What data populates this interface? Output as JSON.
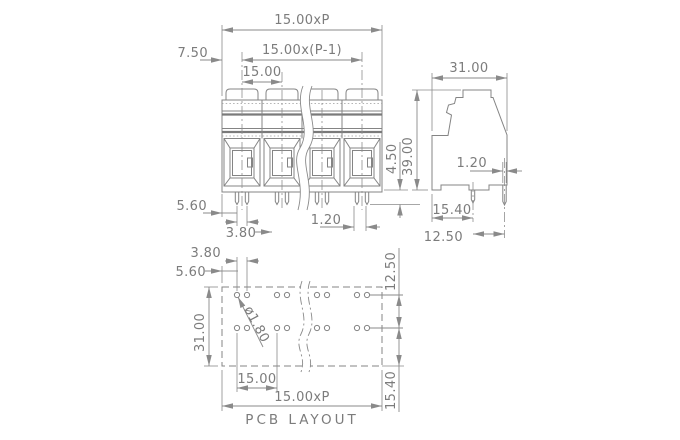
{
  "drawing": {
    "caption": "PCB LAYOUT",
    "front_view": {
      "dim_total_width": "15.00xP",
      "dim_span": "15.00x(P-1)",
      "dim_pitch": "15.00",
      "dim_half_pitch": "7.50",
      "dim_edge_to_pin": "5.60",
      "dim_pin_pair": "3.80",
      "dim_pin_width": "1.20",
      "dim_pin_length": "4.50"
    },
    "side_view": {
      "dim_width": "31.00",
      "dim_height": "39.00",
      "dim_pin_width": "1.20",
      "dim_pin_offset": "15.40",
      "dim_pin_spacing": "12.50"
    },
    "pcb_layout": {
      "dim_hole_pair": "3.80",
      "dim_edge_to_hole": "5.60",
      "dim_depth": "31.00",
      "dim_hole_dia": "ø1.80",
      "dim_pitch": "15.00",
      "dim_total_width": "15.00xP",
      "dim_row_spacing": "12.50",
      "dim_row_offset": "15.40"
    },
    "colors": {
      "line": "#848484",
      "text": "#7c7c7c",
      "background": "#ffffff"
    }
  }
}
